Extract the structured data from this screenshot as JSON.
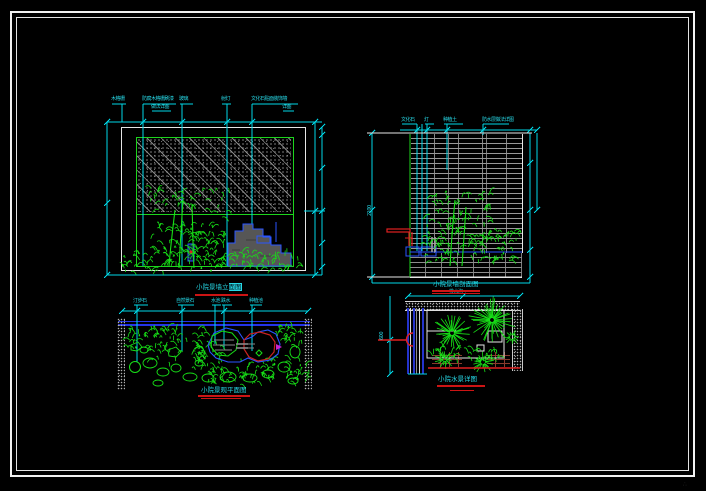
{
  "colors": {
    "background": "#000000",
    "frame": "#f2f2f2",
    "dimension_cyan": "#00d9e8",
    "plant_green": "#17e017",
    "panel_green": "#1dd41d",
    "rock_blue": "#2a55ff",
    "wall_blue": "#2433e8",
    "marker_red": "#e02020",
    "underline_red": "#cc1414",
    "hatch_gray": "#989898",
    "planter_brown": "#8a3a2c"
  },
  "views": {
    "elevation": {
      "labels": [
        "木格栅",
        "防腐木格栅刷漆",
        "做法详图",
        "玻璃",
        "射灯",
        "文化石贴面装饰墙",
        "详图"
      ],
      "title": {
        "text": "小院景墙立",
        "highlight": "面图"
      }
    },
    "section": {
      "labels": [
        "文化石",
        "灯",
        "种植土",
        "防水层做法详图"
      ],
      "side_dim": "2100",
      "title": "小院景墙剖面图"
    },
    "plan": {
      "labels": [
        "汀步石",
        "自然景石",
        "水池",
        "跌水",
        "种植池"
      ],
      "title": "小院景观平面图"
    },
    "detail": {
      "labels": [
        "排水沟"
      ],
      "side_dim": "600",
      "title": "小院水景详图"
    }
  },
  "watermark": "∴"
}
